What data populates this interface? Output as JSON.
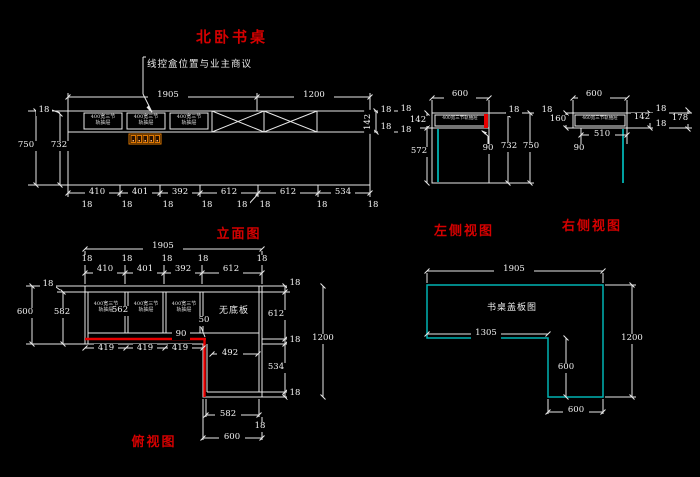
{
  "drawing": {
    "title": "北卧书桌",
    "annotation": "线控盒位置与业主商议",
    "colors": {
      "background": "#000000",
      "line": "#e9e9e9",
      "dim_text": "#f2f2f2",
      "label_red": "#d40000",
      "highlight_red": "#e80000",
      "cyan": "#00b2b2",
      "outlet_orange": "#e07800"
    },
    "views": [
      {
        "name": "elevation",
        "caption": "立面图",
        "labels": [
          {
            "t": "1905",
            "x": 148,
            "y": 91,
            "w": 40
          },
          {
            "t": "1200",
            "x": 294,
            "y": 91,
            "w": 40
          },
          {
            "t": "18",
            "x": 36,
            "y": 106,
            "w": 16
          },
          {
            "t": "750",
            "x": 14,
            "y": 141,
            "w": 24
          },
          {
            "t": "732",
            "x": 47,
            "y": 141,
            "w": 24
          },
          {
            "t": "142",
            "x": 357,
            "y": 117,
            "w": 24,
            "c": "rot"
          },
          {
            "t": "18",
            "x": 378,
            "y": 106,
            "w": 16
          },
          {
            "t": "18",
            "x": 378,
            "y": 123,
            "w": 16
          },
          {
            "t": "410",
            "x": 85,
            "y": 188,
            "w": 24
          },
          {
            "t": "401",
            "x": 128,
            "y": 188,
            "w": 24
          },
          {
            "t": "392",
            "x": 168,
            "y": 188,
            "w": 24
          },
          {
            "t": "612",
            "x": 217,
            "y": 188,
            "w": 24
          },
          {
            "t": "612",
            "x": 276,
            "y": 188,
            "w": 24
          },
          {
            "t": "534",
            "x": 331,
            "y": 188,
            "w": 24
          },
          {
            "t": "18",
            "x": 79,
            "y": 201,
            "w": 16
          },
          {
            "t": "18",
            "x": 119,
            "y": 201,
            "w": 16
          },
          {
            "t": "18",
            "x": 160,
            "y": 201,
            "w": 16
          },
          {
            "t": "18",
            "x": 199,
            "y": 201,
            "w": 16
          },
          {
            "t": "18",
            "x": 234,
            "y": 201,
            "w": 16
          },
          {
            "t": "18",
            "x": 257,
            "y": 201,
            "w": 16
          },
          {
            "t": "18",
            "x": 314,
            "y": 201,
            "w": 16
          },
          {
            "t": "18",
            "x": 365,
            "y": 201,
            "w": 16
          },
          {
            "t": "400宽三节\n轨抽屉",
            "x": 85,
            "y": 114,
            "w": 36,
            "c": "tiny"
          },
          {
            "t": "400宽三节\n轨抽屉",
            "x": 128,
            "y": 114,
            "w": 36,
            "c": "tiny"
          },
          {
            "t": "400宽三节\n轨抽屉",
            "x": 171,
            "y": 114,
            "w": 36,
            "c": "tiny"
          },
          {
            "t": "立面图",
            "x": 213,
            "y": 223,
            "w": 52,
            "c": "red",
            "n": "elevation-caption"
          }
        ]
      },
      {
        "name": "left-side",
        "caption": "左侧视图",
        "labels": [
          {
            "t": "600",
            "x": 444,
            "y": 90,
            "w": 32
          },
          {
            "t": "18",
            "x": 398,
            "y": 105,
            "w": 16
          },
          {
            "t": "142",
            "x": 407,
            "y": 116,
            "w": 22
          },
          {
            "t": "18",
            "x": 398,
            "y": 126,
            "w": 16
          },
          {
            "t": "572",
            "x": 407,
            "y": 147,
            "w": 24
          },
          {
            "t": "90",
            "x": 479,
            "y": 144,
            "w": 18
          },
          {
            "t": "732",
            "x": 497,
            "y": 142,
            "w": 24
          },
          {
            "t": "750",
            "x": 519,
            "y": 142,
            "w": 24
          },
          {
            "t": "18",
            "x": 506,
            "y": 106,
            "w": 16
          },
          {
            "t": "400宽三节轨抽屉",
            "x": 436,
            "y": 116,
            "w": 48,
            "c": "tiny1"
          },
          {
            "t": "左侧视图",
            "x": 433,
            "y": 220,
            "w": 62,
            "c": "red",
            "n": "left-side-caption"
          }
        ]
      },
      {
        "name": "right-side",
        "caption": "右侧视图",
        "labels": [
          {
            "t": "600",
            "x": 578,
            "y": 90,
            "w": 32
          },
          {
            "t": "18",
            "x": 539,
            "y": 106,
            "w": 16
          },
          {
            "t": "160",
            "x": 548,
            "y": 115,
            "w": 20
          },
          {
            "t": "510",
            "x": 589,
            "y": 130,
            "w": 26
          },
          {
            "t": "90",
            "x": 570,
            "y": 144,
            "w": 18
          },
          {
            "t": "142",
            "x": 631,
            "y": 113,
            "w": 22
          },
          {
            "t": "18",
            "x": 653,
            "y": 105,
            "w": 16
          },
          {
            "t": "18",
            "x": 653,
            "y": 120,
            "w": 16
          },
          {
            "t": "178",
            "x": 669,
            "y": 114,
            "w": 22
          },
          {
            "t": "460宽三节轨抽屉",
            "x": 576,
            "y": 116,
            "w": 48,
            "c": "tiny1"
          },
          {
            "t": "右侧视图",
            "x": 561,
            "y": 215,
            "w": 62,
            "c": "red",
            "n": "right-side-caption"
          }
        ]
      },
      {
        "name": "plan",
        "caption": "俯视图",
        "labels": [
          {
            "t": "1905",
            "x": 143,
            "y": 242,
            "w": 40
          },
          {
            "t": "18",
            "x": 79,
            "y": 255,
            "w": 16
          },
          {
            "t": "18",
            "x": 119,
            "y": 255,
            "w": 16
          },
          {
            "t": "18",
            "x": 159,
            "y": 255,
            "w": 16
          },
          {
            "t": "18",
            "x": 195,
            "y": 255,
            "w": 16
          },
          {
            "t": "18",
            "x": 254,
            "y": 255,
            "w": 16
          },
          {
            "t": "410",
            "x": 93,
            "y": 265,
            "w": 24
          },
          {
            "t": "401",
            "x": 133,
            "y": 265,
            "w": 24
          },
          {
            "t": "392",
            "x": 171,
            "y": 265,
            "w": 24
          },
          {
            "t": "612",
            "x": 219,
            "y": 265,
            "w": 24
          },
          {
            "t": "18",
            "x": 40,
            "y": 280,
            "w": 16
          },
          {
            "t": "600",
            "x": 13,
            "y": 308,
            "w": 24
          },
          {
            "t": "582",
            "x": 50,
            "y": 308,
            "w": 24
          },
          {
            "t": "562",
            "x": 109,
            "y": 306,
            "w": 22
          },
          {
            "t": "400宽三节\n轨抽屉",
            "x": 89,
            "y": 301,
            "w": 34,
            "c": "tiny"
          },
          {
            "t": "400宽三节\n轨抽屉",
            "x": 129,
            "y": 301,
            "w": 34,
            "c": "tiny"
          },
          {
            "t": "400宽三节\n轨抽屉",
            "x": 167,
            "y": 301,
            "w": 34,
            "c": "tiny"
          },
          {
            "t": "无底板",
            "x": 212,
            "y": 303,
            "w": 44,
            "c": "wtext"
          },
          {
            "t": "50",
            "x": 196,
            "y": 316,
            "w": 16
          },
          {
            "t": "90",
            "x": 172,
            "y": 330,
            "w": 18
          },
          {
            "t": "419",
            "x": 94,
            "y": 344,
            "w": 24
          },
          {
            "t": "419",
            "x": 133,
            "y": 344,
            "w": 24
          },
          {
            "t": "419",
            "x": 168,
            "y": 344,
            "w": 24
          },
          {
            "t": "492",
            "x": 217,
            "y": 349,
            "w": 26
          },
          {
            "t": "18",
            "x": 287,
            "y": 279,
            "w": 16
          },
          {
            "t": "612",
            "x": 264,
            "y": 310,
            "w": 24
          },
          {
            "t": "18",
            "x": 287,
            "y": 336,
            "w": 16
          },
          {
            "t": "534",
            "x": 264,
            "y": 363,
            "w": 24
          },
          {
            "t": "18",
            "x": 287,
            "y": 389,
            "w": 16
          },
          {
            "t": "1200",
            "x": 309,
            "y": 334,
            "w": 28
          },
          {
            "t": "582",
            "x": 215,
            "y": 410,
            "w": 26
          },
          {
            "t": "18",
            "x": 252,
            "y": 422,
            "w": 16
          },
          {
            "t": "600",
            "x": 219,
            "y": 433,
            "w": 26
          },
          {
            "t": "俯视图",
            "x": 129,
            "y": 431,
            "w": 50,
            "c": "red",
            "n": "plan-caption"
          }
        ]
      },
      {
        "name": "cover-board",
        "caption": "书桌盖板图",
        "labels": [
          {
            "t": "1905",
            "x": 494,
            "y": 265,
            "w": 40
          },
          {
            "t": "书桌盖板图",
            "x": 483,
            "y": 300,
            "w": 58,
            "c": "wtext",
            "n": "cover-board-label"
          },
          {
            "t": "1305",
            "x": 471,
            "y": 329,
            "w": 30
          },
          {
            "t": "600",
            "x": 554,
            "y": 363,
            "w": 24
          },
          {
            "t": "1200",
            "x": 618,
            "y": 334,
            "w": 28
          },
          {
            "t": "600",
            "x": 563,
            "y": 406,
            "w": 26
          }
        ]
      }
    ]
  }
}
